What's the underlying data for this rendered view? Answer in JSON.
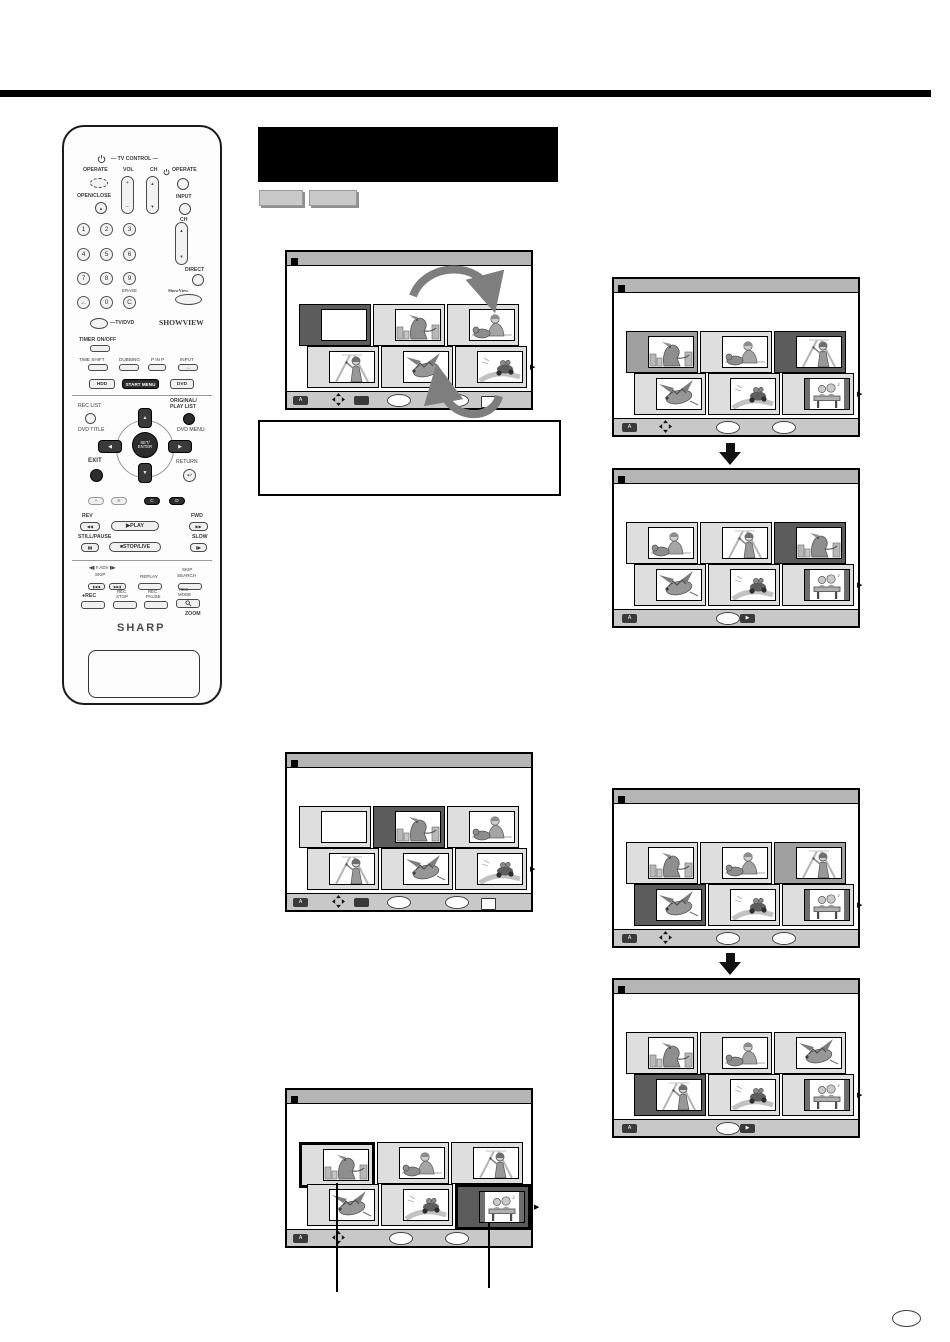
{
  "banner": {
    "title": ""
  },
  "action_buttons": [
    "",
    ""
  ],
  "note_box": {
    "text": ""
  },
  "page_number": "",
  "colors": {
    "cell_light": "#dedede",
    "cell_gray": "#a0a0a0",
    "cell_dark": "#5c5c5c",
    "bar_bg": "#c8c8c8",
    "titlebar_bg": "#b5b5b5",
    "arrow_gray": "#7e7e7e"
  },
  "remote": {
    "operate_left": "OPERATE",
    "tv_control": "— TV CONTROL —",
    "vol": "VOL",
    "ch": "CH",
    "operate_right": "OPERATE",
    "open_close": "OPEN/CLOSE",
    "input": "INPUT",
    "ch_right": "CH",
    "digits": [
      "1",
      "2",
      "3",
      "4",
      "5",
      "6",
      "7",
      "8",
      "9"
    ],
    "dash": "-/--",
    "zero": "0",
    "erase": "ERASE",
    "c_key": "C",
    "direct": "DIRECT",
    "showview_key": "ShowView",
    "tv_dvd": "—TV/DVD",
    "showview_logo": "SHOWVIEW",
    "timer": "TIMER ON/OFF",
    "time_shift": "TIME SHIFT",
    "dubbing": "DUBBING",
    "p_in_p": "P IN P",
    "input2": "INPUT",
    "input_arrow": "→",
    "hdd": "HDD",
    "start_menu": "START MENU",
    "dvd": "DVD",
    "rec_list": "REC LIST",
    "original": "ORIGINAL/",
    "play_list": "PLAY LIST",
    "dvd_title": "DVD TITLE",
    "dvd_menu": "DVD MENU",
    "set1": "SET/",
    "set2": "ENTER",
    "exit": "EXIT",
    "return": "RETURN",
    "return_icon": "↩",
    "abcd": [
      "A",
      "B",
      "C",
      "D"
    ],
    "rev": "REV",
    "fwd": "FWD",
    "rev_glyph": "◀◀",
    "play_glyph": "▶PLAY",
    "fwd_glyph": "▶▶",
    "still_pause": "STILL/PAUSE",
    "slow": "SLOW",
    "pause_glyph": "▮▮",
    "stop_glyph": "■STOP/LIVE",
    "slow_glyph": "▮▶",
    "fadv": "◀▮ F.ADV ▮▶",
    "skip": "SKIP",
    "replay": "REPLAY",
    "skip2": "SKIP",
    "search": "SEARCH",
    "skip_back": "▮◀◀",
    "skip_fwd": "▶▶▮",
    "rec": "●REC",
    "rec2": "REC",
    "stop2": "STOP",
    "rec3": "REC",
    "pause2": "PAUSE",
    "rec4": "REC",
    "mode": "MODE",
    "zoom": "ZOOM",
    "up": "▲",
    "down": "▼",
    "left": "◀",
    "right": "▶",
    "plus": "+",
    "minus": "−",
    "tri_up": "▲",
    "tri_down": "▼",
    "brand": "SHARP"
  },
  "screens": [
    {
      "id": "edit-scene-select",
      "cells": [
        {
          "scene": "blank",
          "state": "dark"
        },
        {
          "scene": "dinosaur",
          "state": "light"
        },
        {
          "scene": "boydog",
          "state": "light"
        },
        {
          "scene": "woman",
          "state": "light"
        },
        {
          "scene": "dragon",
          "state": "light"
        },
        {
          "scene": "bike",
          "state": "light"
        }
      ],
      "controls": [
        {
          "type": "keyd",
          "x": 6,
          "label": "A"
        },
        {
          "type": "dpad",
          "x": 45
        },
        {
          "type": "keyd",
          "x": 67,
          "label": ""
        },
        {
          "type": "oval",
          "x": 100
        },
        {
          "type": "oval",
          "x": 158
        },
        {
          "type": "keyl",
          "x": 194,
          "label": ""
        }
      ]
    },
    {
      "id": "move-title-select",
      "cells": [
        {
          "scene": "dinosaur",
          "state": "gray"
        },
        {
          "scene": "boydog",
          "state": "light"
        },
        {
          "scene": "woman",
          "state": "dark"
        },
        {
          "scene": "dragon",
          "state": "light"
        },
        {
          "scene": "bike",
          "state": "light"
        },
        {
          "scene": "bench",
          "state": "light"
        }
      ],
      "controls": [
        {
          "type": "keyd",
          "x": 8,
          "label": "A"
        },
        {
          "type": "dpad",
          "x": 45
        },
        {
          "type": "oval",
          "x": 102
        },
        {
          "type": "oval",
          "x": 158
        }
      ]
    },
    {
      "id": "move-title-result",
      "cells": [
        {
          "scene": "boydog",
          "state": "light"
        },
        {
          "scene": "woman",
          "state": "light"
        },
        {
          "scene": "dinosaur",
          "state": "dark"
        },
        {
          "scene": "dragon",
          "state": "light"
        },
        {
          "scene": "bike",
          "state": "light"
        },
        {
          "scene": "bench",
          "state": "light"
        }
      ],
      "controls": [
        {
          "type": "keyd",
          "x": 8,
          "label": "A"
        },
        {
          "type": "oval",
          "x": 102
        },
        {
          "type": "keyd",
          "x": 126,
          "label": "▶"
        }
      ]
    },
    {
      "id": "edit-scene-position",
      "cells": [
        {
          "scene": "blank",
          "state": "light"
        },
        {
          "scene": "dinosaur",
          "state": "dark"
        },
        {
          "scene": "boydog",
          "state": "light"
        },
        {
          "scene": "woman",
          "state": "light"
        },
        {
          "scene": "dragon",
          "state": "light"
        },
        {
          "scene": "bike",
          "state": "light"
        }
      ],
      "controls": [
        {
          "type": "keyd",
          "x": 6,
          "label": "A"
        },
        {
          "type": "dpad",
          "x": 45
        },
        {
          "type": "keyd",
          "x": 67,
          "label": ""
        },
        {
          "type": "oval",
          "x": 100
        },
        {
          "type": "oval",
          "x": 158
        },
        {
          "type": "keyl",
          "x": 194,
          "label": ""
        }
      ]
    },
    {
      "id": "scene-callout",
      "cells": [
        {
          "scene": "dinosaur",
          "state": "light",
          "thick": true
        },
        {
          "scene": "boydog",
          "state": "light"
        },
        {
          "scene": "woman",
          "state": "light"
        },
        {
          "scene": "dragon",
          "state": "light"
        },
        {
          "scene": "bike",
          "state": "light"
        },
        {
          "scene": "bench",
          "state": "dark",
          "thick": true
        }
      ],
      "controls": [
        {
          "type": "keyd",
          "x": 6,
          "label": "A"
        },
        {
          "type": "dpad",
          "x": 45
        },
        {
          "type": "oval",
          "x": 102
        },
        {
          "type": "oval",
          "x": 158
        }
      ]
    },
    {
      "id": "move-scene-select",
      "cells": [
        {
          "scene": "dinosaur",
          "state": "light"
        },
        {
          "scene": "boydog",
          "state": "light"
        },
        {
          "scene": "woman",
          "state": "gray"
        },
        {
          "scene": "dragon",
          "state": "dark"
        },
        {
          "scene": "bike",
          "state": "light"
        },
        {
          "scene": "bench",
          "state": "light"
        }
      ],
      "controls": [
        {
          "type": "keyd",
          "x": 8,
          "label": "A"
        },
        {
          "type": "dpad",
          "x": 45
        },
        {
          "type": "oval",
          "x": 102
        },
        {
          "type": "oval",
          "x": 158
        }
      ]
    },
    {
      "id": "move-scene-result",
      "cells": [
        {
          "scene": "dinosaur",
          "state": "light"
        },
        {
          "scene": "boydog",
          "state": "light"
        },
        {
          "scene": "dragon",
          "state": "light"
        },
        {
          "scene": "woman",
          "state": "dark"
        },
        {
          "scene": "bike",
          "state": "light"
        },
        {
          "scene": "bench",
          "state": "light"
        }
      ],
      "controls": [
        {
          "type": "keyd",
          "x": 8,
          "label": "A"
        },
        {
          "type": "oval",
          "x": 102
        },
        {
          "type": "keyd",
          "x": 126,
          "label": "▶"
        }
      ]
    }
  ]
}
